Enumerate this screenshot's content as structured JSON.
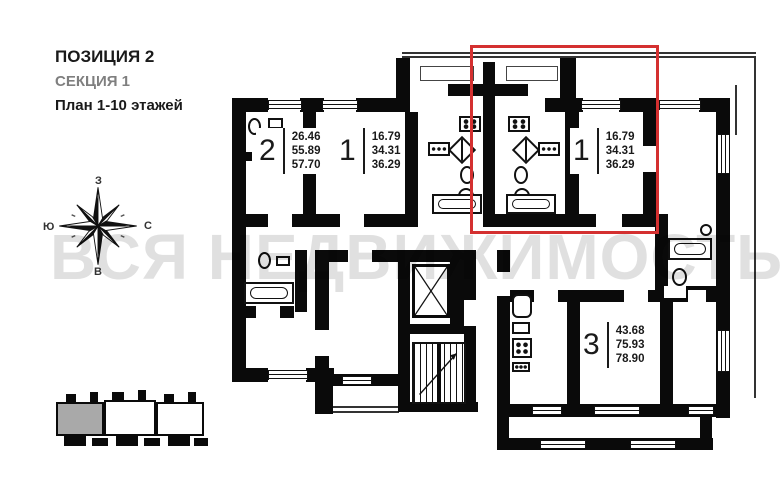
{
  "header": {
    "position": "ПОЗИЦИЯ 2",
    "section": "СЕКЦИЯ 1",
    "floors": "План 1-10 этажей"
  },
  "watermark": {
    "text": "ВСЯ НЕДВИЖИМОСТЬ"
  },
  "compass": {
    "top": "З",
    "right": "С",
    "left": "Ю",
    "bottom": "В"
  },
  "apartments": [
    {
      "id": "apt-2",
      "number": "2",
      "areas": [
        "26.46",
        "55.89",
        "57.70"
      ],
      "areas_text": "26.46\n55.89\n57.70",
      "highlighted": false
    },
    {
      "id": "apt-1-left",
      "number": "1",
      "areas": [
        "16.79",
        "34.31",
        "36.29"
      ],
      "areas_text": "16.79\n34.31\n36.29",
      "highlighted": false
    },
    {
      "id": "apt-1-right",
      "number": "1",
      "areas": [
        "16.79",
        "34.31",
        "36.29"
      ],
      "areas_text": "16.79\n34.31\n36.29",
      "highlighted": true
    },
    {
      "id": "apt-3",
      "number": "3",
      "areas": [
        "43.68",
        "75.93",
        "78.90"
      ],
      "areas_text": "43.68\n75.93\n78.90",
      "highlighted": false
    }
  ],
  "colors": {
    "highlight": "#d43030",
    "section_text": "#7f7f7f",
    "wall": "#0a0a0a",
    "watermark": "#d9d9d9",
    "site_highlight": "#a9a9a9"
  }
}
